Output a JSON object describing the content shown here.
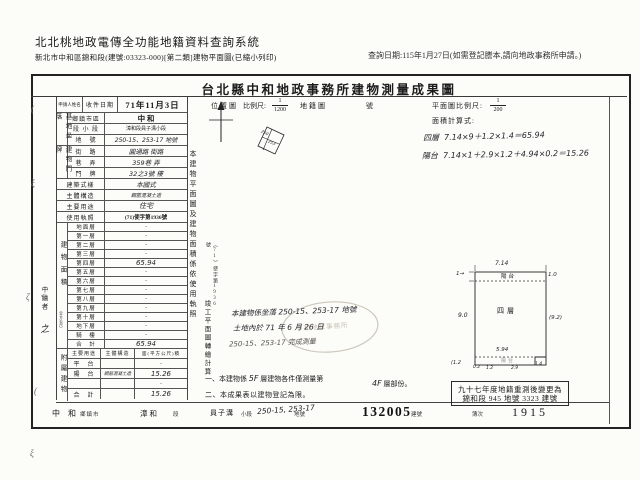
{
  "header": {
    "system_title": "北北桃地政電傳全功能地籍資料查詢系統",
    "subtitle": "新北市中和區錦和段(建號:03323-000)[第二類]建物平面圖(已縮小列印)",
    "query_date": "查詢日期:115年1月27日(如需登記謄本,請向地政事務所申請。)"
  },
  "form": {
    "title": "台北縣中和地政事務所建物測量成果圖",
    "applicant_label": "申請人姓名",
    "received_label": "收件日期",
    "received_date": "71年11月3日",
    "site": {
      "group": "基地坐落",
      "rows": [
        {
          "label": "鄉鎮市區",
          "value": "中 和"
        },
        {
          "label": "段 小 段",
          "value": "漳和段員子溝小段"
        },
        {
          "label": "地　號",
          "value": "250-15、253-17 地號"
        }
      ]
    },
    "address": {
      "group": "建物門牌",
      "rows": [
        {
          "label": "街　路",
          "value": "圓通路 街路"
        },
        {
          "label": "巷　弄",
          "value": "359巷 弄"
        },
        {
          "label": "門　牌",
          "value": "32之3號 樓"
        }
      ]
    },
    "style_row": {
      "label": "建築式樣",
      "value": "本國式"
    },
    "structure_row": {
      "label": "主體構造",
      "value": "鋼筋混凝土造"
    },
    "usage_row": {
      "label": "主要用途",
      "value": "住宅"
    },
    "license_row": {
      "label": "使用執照",
      "value": "(71)使字第1936號"
    },
    "area": {
      "group": "建物面積",
      "unit": "（平方公尺）",
      "rows": [
        {
          "label": "地面層",
          "value": "·"
        },
        {
          "label": "第一層",
          "value": "·"
        },
        {
          "label": "第二層",
          "value": "·"
        },
        {
          "label": "第三層",
          "value": "·"
        },
        {
          "label": "第四層",
          "value": "65.94"
        },
        {
          "label": "第五層",
          "value": "·"
        },
        {
          "label": "第六層",
          "value": "·"
        },
        {
          "label": "第七層",
          "value": "·"
        },
        {
          "label": "第八層",
          "value": "·"
        },
        {
          "label": "第九層",
          "value": "·"
        },
        {
          "label": "第十層",
          "value": "·"
        },
        {
          "label": "地下層",
          "value": "·"
        },
        {
          "label": "騎　樓",
          "value": "·"
        },
        {
          "label": "合　計",
          "value": "65.94"
        }
      ]
    },
    "annex": {
      "group": "附屬建物",
      "header": {
        "c1": "主要用途",
        "c2": "主體構造",
        "c3": "面(平方公尺)積"
      },
      "rows": [
        {
          "c1": "平　台",
          "c2": "",
          "c3": "·"
        },
        {
          "c1": "陽　台",
          "c2": "鋼筋混凝土造",
          "c3": "15.26"
        },
        {
          "c1": "",
          "c2": "",
          "c3": "·"
        },
        {
          "c1": "合　計",
          "c2": "",
          "c3": "15.26"
        }
      ]
    },
    "drafter_label": "中繪者",
    "drafter_sign": "之"
  },
  "middle": {
    "location_label": "位置圖",
    "scale_label": "比例尺:",
    "scale_num": "1",
    "scale_den": "1200",
    "cadastral_label": "地籍圖",
    "cadastral_no_label": "號",
    "vertical_note": "本建物平面圖及建物面積係依使用執照",
    "vertical_note_small": "（71）使字第1936號",
    "vertical_note2": "竣工平面圖轉繪計算",
    "hand_note1": "本建物係坐落 250-15、253-17 地號",
    "hand_note2": "土地內於 71 年 6 月 26 日",
    "hand_note3": "250-15、253-17 完成測量",
    "stamp_text": "中和地政事務所",
    "sketch_num_a": "250",
    "sketch_num_b": "253",
    "note1_lead": "一、本建物係",
    "note1_ins1": "5F",
    "note1_mid": "層建物各件僅測量第",
    "note1_ins2": "4F",
    "note1_tail": "層部份。",
    "note2": "二、本成果表以建物登記為限。"
  },
  "plan_section": {
    "scale_label": "平面圖比例尺:",
    "scale_num": "1",
    "scale_den": "200",
    "formula_label": "面積計算式:",
    "formula1_name": "四層",
    "formula1": "7.14×9＋1.2×1.4＝65.94",
    "formula2_name": "陽台",
    "formula2": "7.14×1＋2.9×1.2＋4.94×0.2＝15.26",
    "plan": {
      "top_dim": "7.14",
      "top_left": "1→",
      "top_right": "1.0",
      "top_strip": "陽台",
      "left_dim": "9.0",
      "right_dim": "(9.2)",
      "center": "四層",
      "bottom_dim": "5.94",
      "bottom_strip": "陽台",
      "b1": "0.2",
      "b2": "1.2",
      "b3": "2.9",
      "b4": "1.4",
      "outside_left": "(1.2"
    },
    "change_box_line1": "九十七年度地籍重測後變更為",
    "change_box_line2": "錦和段 945 地號 3323 建號"
  },
  "bottom": {
    "town": "中 和",
    "town_label": "鄉鎮市",
    "sec": "漳和",
    "sec_label": "段",
    "subsec": "員子溝",
    "subsec_label": "小段",
    "parcel": "250-15, 253-17",
    "parcel_label": "地號",
    "reg_no": "132005",
    "reg_no_label": "建號",
    "book_label": "簿次",
    "book_no": "1915"
  },
  "marks": {
    "m1": "(",
    "m2": "ξ",
    "m3": "ζ",
    "m4": "<",
    "m5": "(",
    "m6": "ξ"
  }
}
